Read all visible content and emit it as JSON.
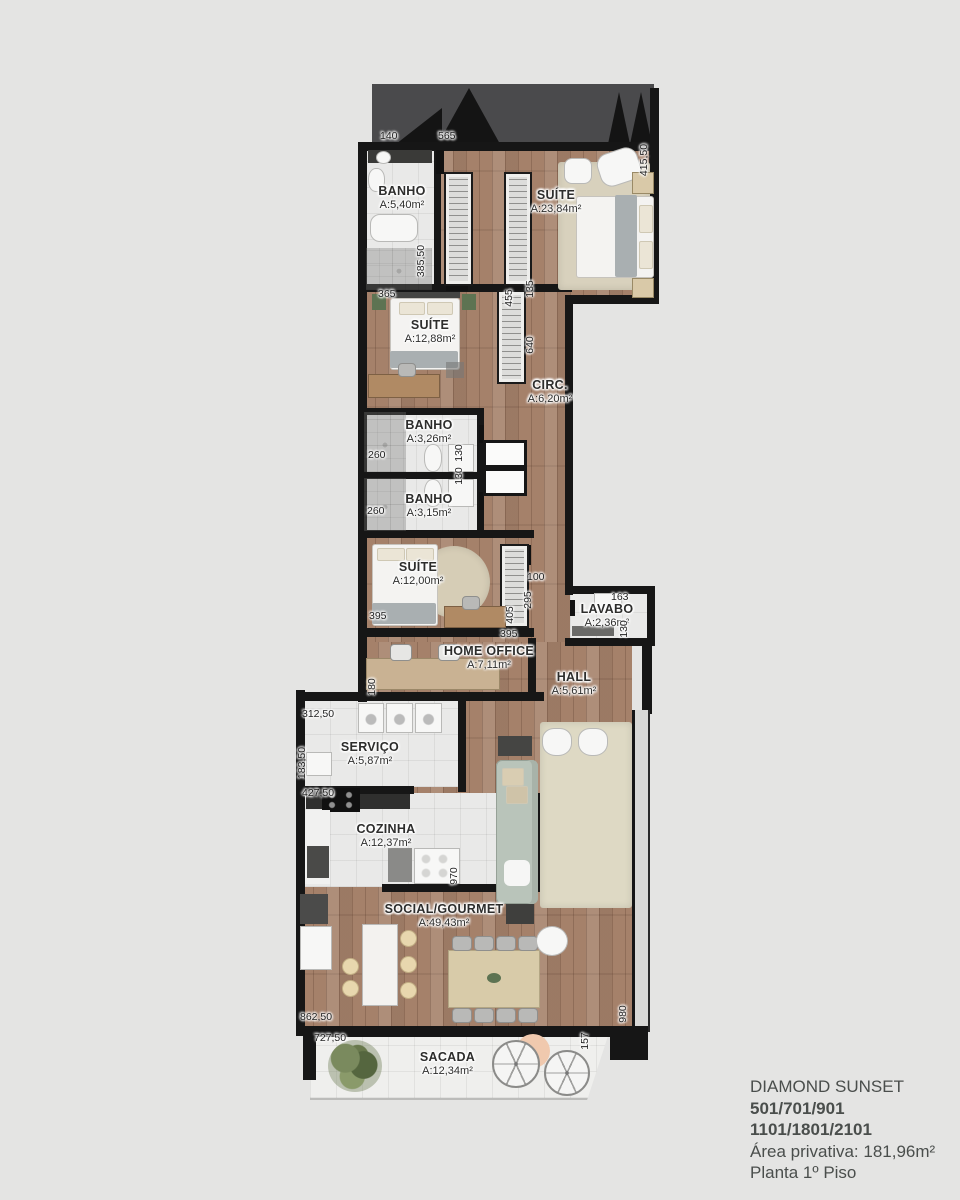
{
  "info": {
    "title": "DIAMOND SUNSET",
    "units_line1": "501/701/901",
    "units_line2": "1101/1801/2101",
    "area_line": "Área privativa: 181,96m²",
    "floor_line": "Planta 1º Piso"
  },
  "rooms": [
    {
      "name": "BANHO",
      "area": "A:5,40m²"
    },
    {
      "name": "SUÍTE",
      "area": "A:23,84m²"
    },
    {
      "name": "SUÍTE",
      "area": "A:12,88m²"
    },
    {
      "name": "CIRC.",
      "area": "A:6,20m²"
    },
    {
      "name": "BANHO",
      "area": "A:3,26m²"
    },
    {
      "name": "BANHO",
      "area": "A:3,15m²"
    },
    {
      "name": "SUÍTE",
      "area": "A:12,00m²"
    },
    {
      "name": "LAVABO",
      "area": "A:2,36m²"
    },
    {
      "name": "HOME OFFICE",
      "area": "A:7,11m²"
    },
    {
      "name": "HALL",
      "area": "A:5,61m²"
    },
    {
      "name": "SERVIÇO",
      "area": "A:5,87m²"
    },
    {
      "name": "COZINHA",
      "area": "A:12,37m²"
    },
    {
      "name": "SOCIAL/GOURMET",
      "area": "A:49,43m²"
    },
    {
      "name": "SACADA",
      "area": "A:12,34m²"
    }
  ],
  "dims": [
    "140",
    "565",
    "415,50",
    "385,50",
    "365",
    "455",
    "135",
    "640",
    "260",
    "130",
    "130",
    "260",
    "395",
    "405",
    "295",
    "100",
    "163",
    "130",
    "395",
    "180",
    "312,50",
    "183,50",
    "427,50",
    "970",
    "862,50",
    "727,50",
    "980",
    "157"
  ],
  "colors": {
    "background": "#e4e4e3",
    "wall": "#161616",
    "roof_band": "#4a4a4c",
    "wood_floor": "#a5816a",
    "tile_floor": "#e9e9e8",
    "rug": "#d8d1bd",
    "sofa": "#b9c4ba",
    "label_text": "#2d2d2c",
    "info_text": "#4a4e4c"
  }
}
